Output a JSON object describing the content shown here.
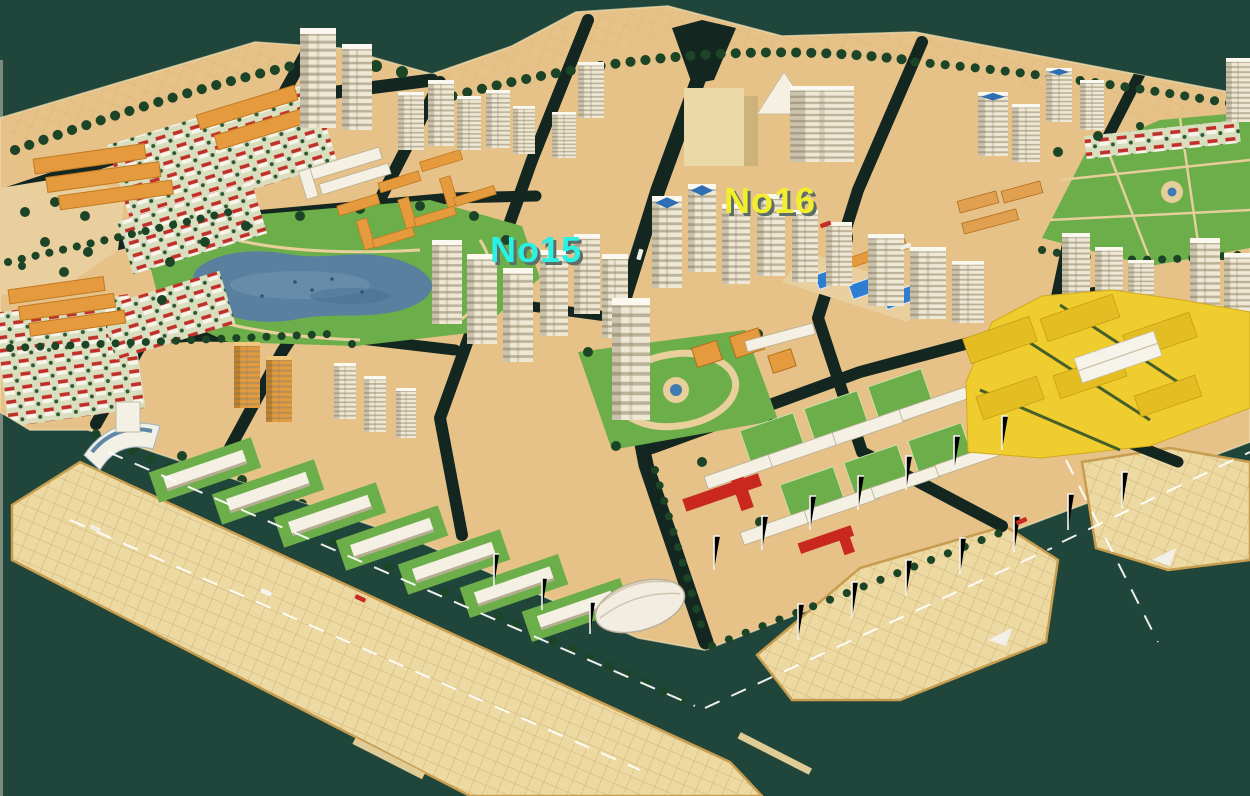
{
  "scene": {
    "title": "Residential district master plan - aerial isometric rendering",
    "type": "urban-planning-model",
    "labels": {
      "no15": {
        "text": "No15",
        "color": "#2bf0e4",
        "shadow": "#5c6e67"
      },
      "no16": {
        "text": "No16",
        "color": "#f2ee2e",
        "shadow": "#5c6e67"
      }
    },
    "palette": {
      "background": "#20453a",
      "land": "#e6c289",
      "plaza": "#edd9a2",
      "road": "#132620",
      "park_green": "#6cae49",
      "lake_blue": "#59809f",
      "villa_roof_red": "#c03028",
      "orange_building": "#e59b3d",
      "tower_cream": "#efe8d4",
      "yellow_complex": "#f0cd2f",
      "shed_roof_blue": "#2e7ecf",
      "red_accent": "#c8281e",
      "tree_green": "#1c4427"
    }
  }
}
